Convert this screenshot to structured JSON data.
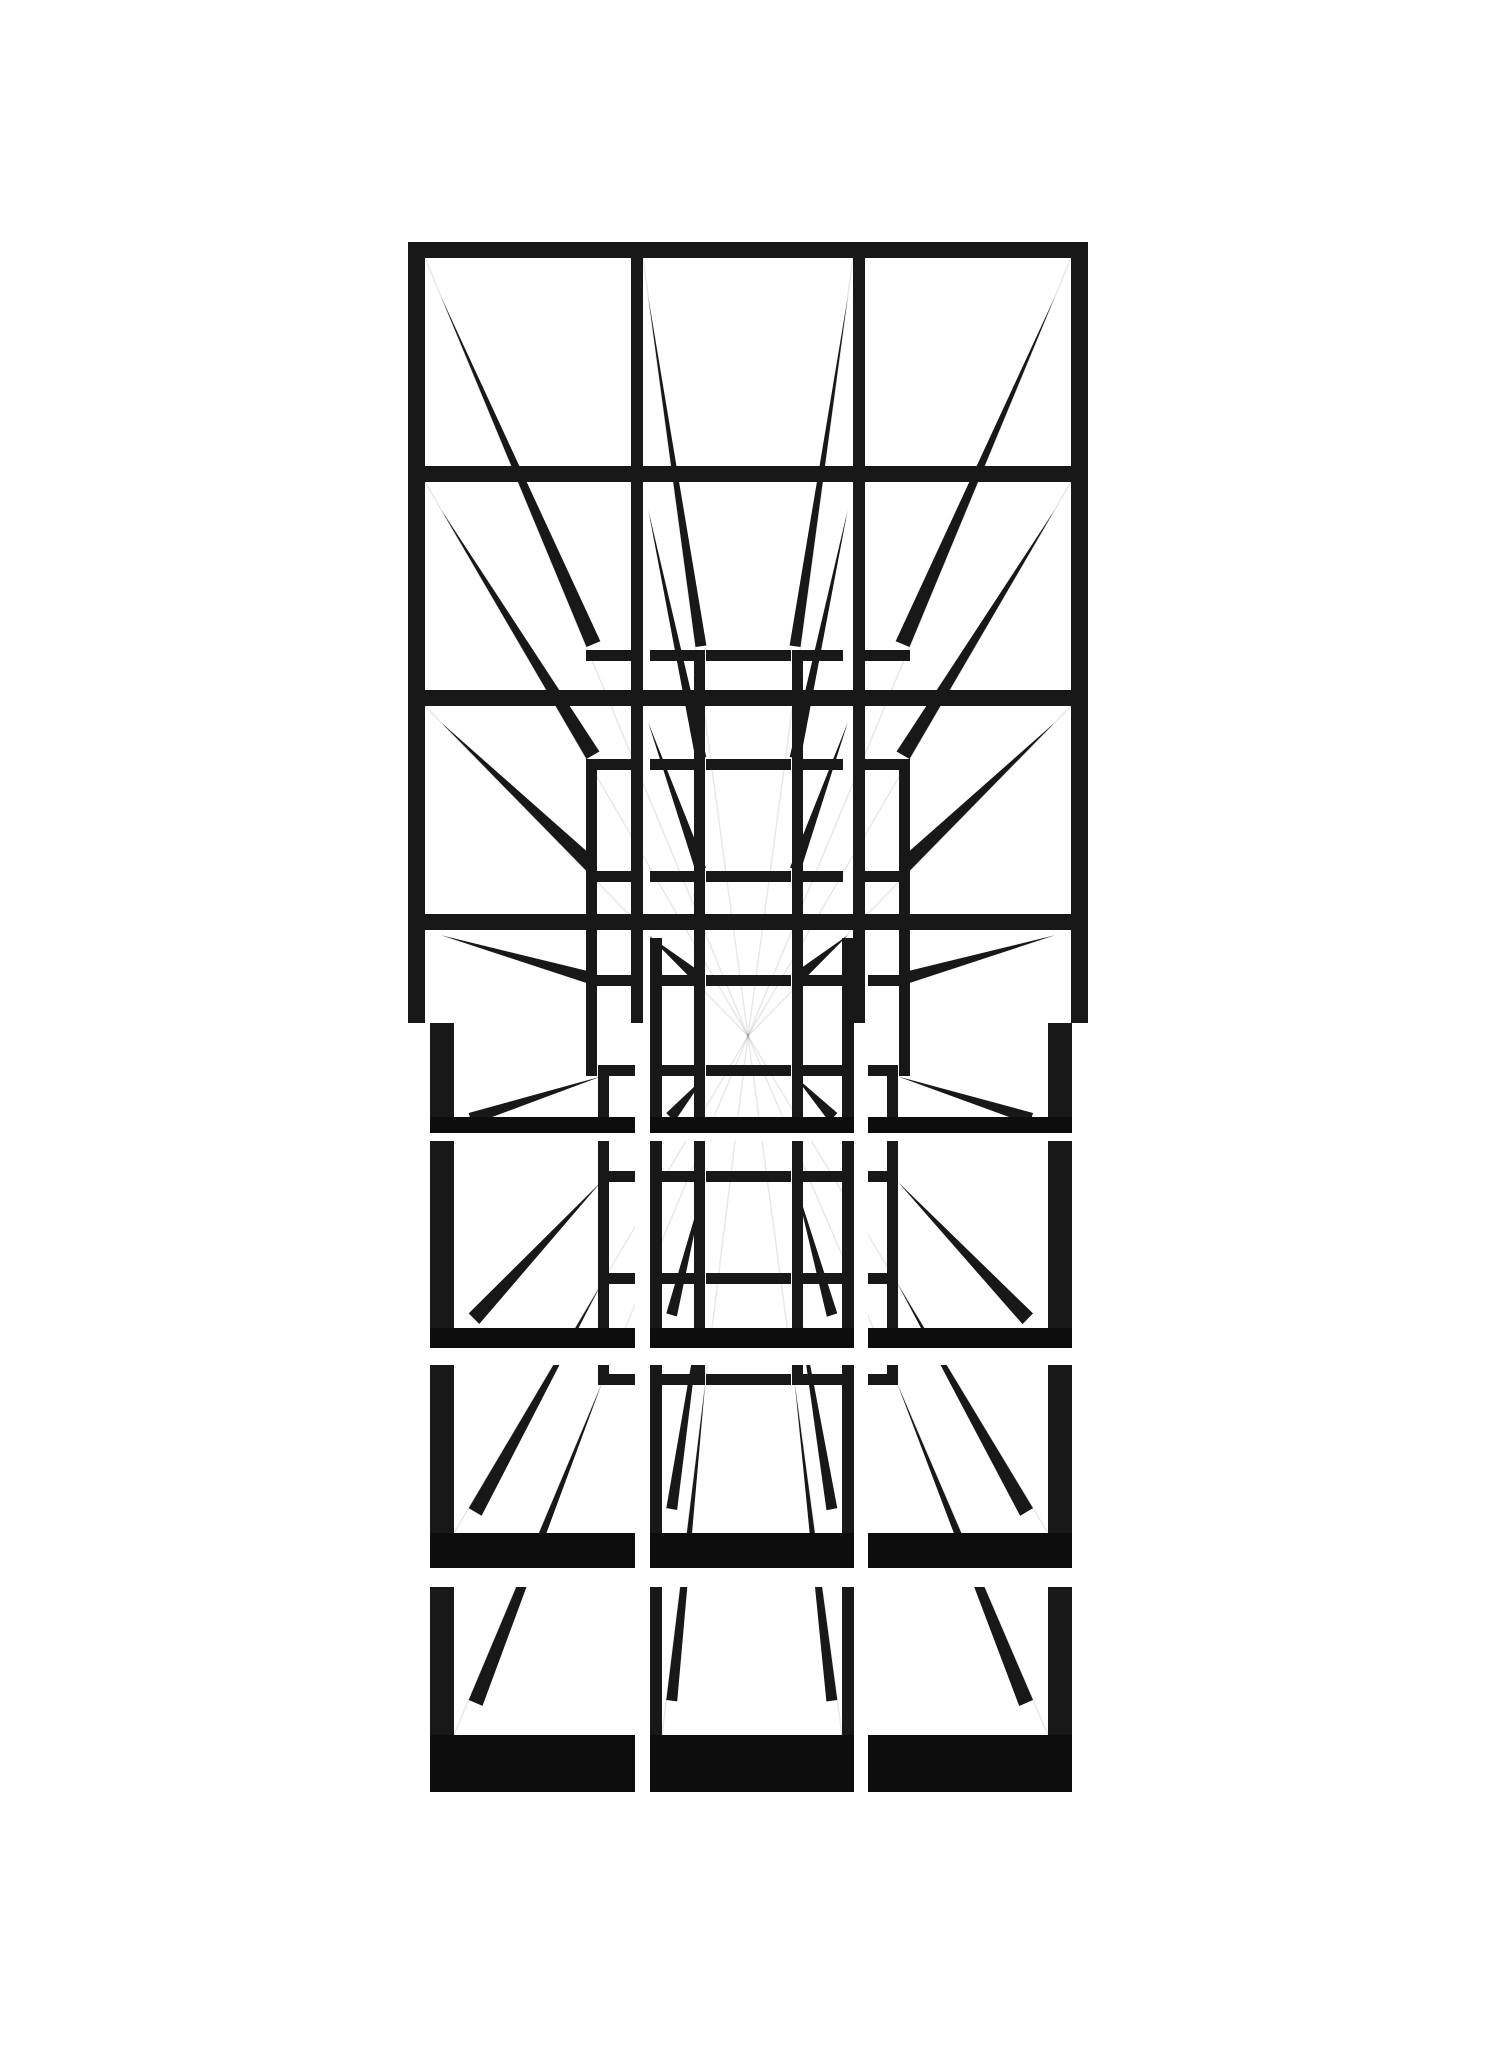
{
  "artwork": {
    "kind": "ink-perspective-grid-drawing",
    "canvas": {
      "width": 1499,
      "height": 2048
    },
    "colors": {
      "background": "#ffffff",
      "ink": "#181818",
      "ink_heavy": "#0d0d0d",
      "pencil": "rgba(0,0,0,0.09)"
    },
    "vanishing_point": {
      "x": 748,
      "y": 1036
    },
    "pencil_guides": [
      [
        425,
        258
      ],
      [
        643,
        258
      ],
      [
        853,
        258
      ],
      [
        1071,
        258
      ],
      [
        425,
        482
      ],
      [
        1071,
        482
      ],
      [
        425,
        706
      ],
      [
        1071,
        706
      ],
      [
        454,
        1735
      ],
      [
        662,
        1735
      ],
      [
        842,
        1735
      ],
      [
        1048,
        1735
      ],
      [
        454,
        1533
      ],
      [
        1048,
        1533
      ]
    ],
    "far_bars": [
      [
        586,
        650,
        45,
        11
      ],
      [
        586,
        759,
        45,
        11
      ],
      [
        586,
        871,
        45,
        11
      ],
      [
        586,
        975,
        45,
        11
      ],
      [
        865,
        650,
        45,
        11
      ],
      [
        865,
        759,
        45,
        11
      ],
      [
        865,
        871,
        45,
        11
      ],
      [
        865,
        975,
        45,
        11
      ],
      [
        650,
        650,
        44,
        11
      ],
      [
        706,
        650,
        85,
        11
      ],
      [
        803,
        650,
        40,
        11
      ],
      [
        650,
        759,
        44,
        11
      ],
      [
        706,
        759,
        85,
        11
      ],
      [
        803,
        759,
        40,
        11
      ],
      [
        650,
        871,
        44,
        11
      ],
      [
        706,
        871,
        85,
        11
      ],
      [
        803,
        871,
        40,
        11
      ],
      [
        650,
        975,
        44,
        11
      ],
      [
        706,
        975,
        85,
        11
      ],
      [
        803,
        975,
        40,
        11
      ],
      [
        598,
        1065,
        37,
        11
      ],
      [
        598,
        1171,
        37,
        11
      ],
      [
        598,
        1273,
        37,
        11
      ],
      [
        598,
        1374,
        37,
        11
      ],
      [
        868,
        1065,
        30,
        11
      ],
      [
        868,
        1171,
        30,
        11
      ],
      [
        868,
        1273,
        30,
        11
      ],
      [
        868,
        1374,
        30,
        11
      ],
      [
        662,
        1065,
        32,
        11
      ],
      [
        706,
        1065,
        85,
        11
      ],
      [
        803,
        1065,
        39,
        11
      ],
      [
        662,
        1171,
        32,
        11
      ],
      [
        706,
        1171,
        85,
        11
      ],
      [
        803,
        1171,
        39,
        11
      ],
      [
        662,
        1273,
        32,
        11
      ],
      [
        706,
        1273,
        85,
        11
      ],
      [
        803,
        1273,
        39,
        11
      ],
      [
        662,
        1374,
        32,
        11
      ],
      [
        706,
        1374,
        85,
        11
      ],
      [
        803,
        1374,
        39,
        11
      ]
    ],
    "far_verts": [
      [
        694,
        650,
        11,
        426
      ],
      [
        792,
        650,
        11,
        426
      ],
      [
        586,
        759,
        11,
        317
      ],
      [
        899,
        759,
        11,
        317
      ],
      [
        694,
        1076,
        11,
        309
      ],
      [
        792,
        1076,
        11,
        309
      ],
      [
        598,
        1065,
        11,
        320
      ],
      [
        887,
        1065,
        11,
        320
      ]
    ],
    "rays": [
      [
        425,
        258,
        15
      ],
      [
        643,
        258,
        11
      ],
      [
        853,
        258,
        11
      ],
      [
        1071,
        258,
        15
      ],
      [
        425,
        482,
        15
      ],
      [
        643,
        482,
        11
      ],
      [
        853,
        482,
        11
      ],
      [
        1071,
        482,
        15
      ],
      [
        425,
        706,
        15
      ],
      [
        643,
        706,
        11
      ],
      [
        853,
        706,
        11
      ],
      [
        1071,
        706,
        15
      ],
      [
        425,
        930,
        12
      ],
      [
        643,
        930,
        12
      ],
      [
        853,
        930,
        12
      ],
      [
        1071,
        930,
        12
      ],
      [
        454,
        1117,
        12
      ],
      [
        662,
        1117,
        12
      ],
      [
        842,
        1117,
        12
      ],
      [
        1048,
        1117,
        12
      ],
      [
        454,
        1328,
        15
      ],
      [
        662,
        1328,
        11
      ],
      [
        842,
        1328,
        11
      ],
      [
        1048,
        1328,
        15
      ],
      [
        454,
        1533,
        15
      ],
      [
        662,
        1533,
        11
      ],
      [
        842,
        1533,
        11
      ],
      [
        1048,
        1533,
        15
      ],
      [
        454,
        1735,
        15
      ],
      [
        662,
        1735,
        11
      ],
      [
        842,
        1735,
        11
      ],
      [
        1048,
        1735,
        15
      ]
    ],
    "ray_taper": {
      "t_start": 0.05,
      "t_end": 0.5
    },
    "white_masks": [
      [
        0,
        0,
        1499,
        242
      ],
      [
        0,
        1792,
        1499,
        256
      ],
      [
        0,
        242,
        408,
        781
      ],
      [
        1088,
        242,
        411,
        781
      ],
      [
        0,
        1023,
        430,
        769
      ],
      [
        1072,
        1023,
        427,
        769
      ],
      [
        430,
        1133,
        642,
        8
      ],
      [
        430,
        1348,
        642,
        17
      ],
      [
        430,
        1568,
        642,
        19
      ],
      [
        635,
        930,
        15,
        862
      ],
      [
        854,
        930,
        14,
        862
      ]
    ],
    "grid_h_bars": [
      [
        408,
        242,
        680,
        16
      ],
      [
        408,
        466,
        680,
        16
      ],
      [
        408,
        690,
        680,
        16
      ],
      [
        408,
        914,
        680,
        16
      ]
    ],
    "grid_v_bars": [
      [
        408,
        242,
        17,
        781
      ],
      [
        631,
        242,
        12,
        781
      ],
      [
        853,
        242,
        12,
        781
      ],
      [
        1071,
        242,
        17,
        781
      ]
    ],
    "frame_verts": [
      [
        430,
        1023,
        24,
        110
      ],
      [
        650,
        938,
        12,
        195
      ],
      [
        842,
        938,
        12,
        195
      ],
      [
        1048,
        1023,
        24,
        110
      ],
      [
        430,
        1141,
        24,
        207
      ],
      [
        650,
        1141,
        12,
        207
      ],
      [
        842,
        1141,
        12,
        207
      ],
      [
        1048,
        1141,
        24,
        207
      ],
      [
        430,
        1365,
        24,
        203
      ],
      [
        650,
        1365,
        12,
        203
      ],
      [
        842,
        1365,
        12,
        203
      ],
      [
        1048,
        1365,
        24,
        203
      ],
      [
        430,
        1587,
        24,
        205
      ],
      [
        650,
        1587,
        12,
        205
      ],
      [
        842,
        1587,
        12,
        205
      ],
      [
        1048,
        1587,
        24,
        205
      ]
    ],
    "frame_floors": [
      [
        430,
        1117,
        205,
        16
      ],
      [
        650,
        1117,
        204,
        16
      ],
      [
        868,
        1117,
        204,
        16
      ],
      [
        430,
        1328,
        205,
        20
      ],
      [
        650,
        1328,
        204,
        20
      ],
      [
        868,
        1328,
        204,
        20
      ],
      [
        430,
        1533,
        205,
        35
      ],
      [
        650,
        1533,
        204,
        35
      ],
      [
        868,
        1533,
        204,
        35
      ],
      [
        430,
        1735,
        205,
        57
      ],
      [
        650,
        1735,
        204,
        57
      ],
      [
        868,
        1735,
        204,
        57
      ]
    ]
  }
}
